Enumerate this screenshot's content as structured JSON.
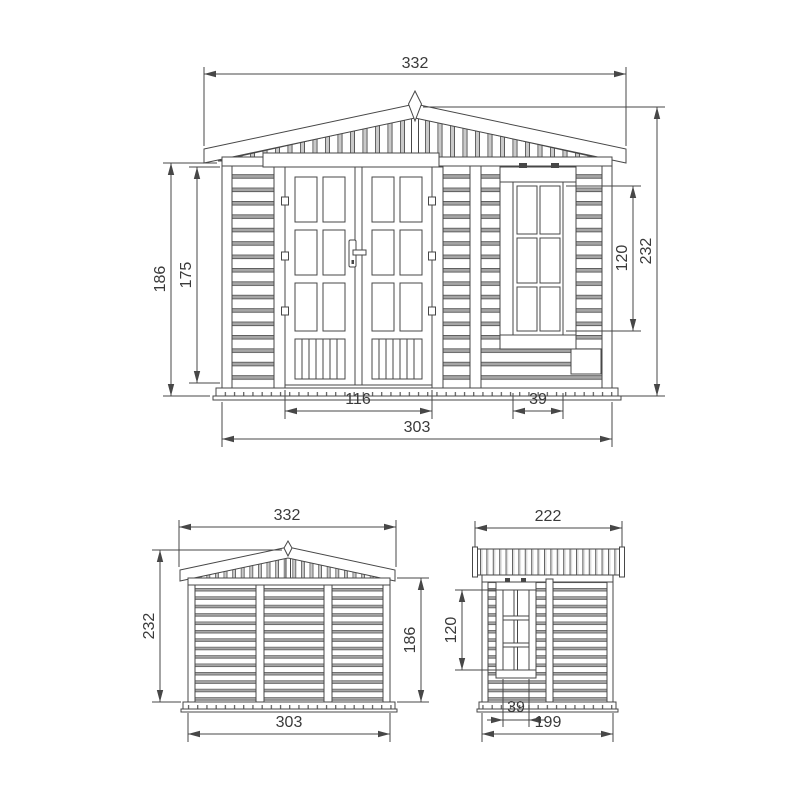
{
  "style": {
    "line_color": "#474747",
    "dim_text_color": "#3a3a3a",
    "background": "#ffffff",
    "shade_gray": "#a6a6a6"
  },
  "front_view": {
    "dim_roof_width": "332",
    "dim_total_height": "232",
    "dim_wall_height": "186",
    "dim_door_height": "175",
    "dim_window_height": "120",
    "dim_door_width": "116",
    "dim_window_width": "39",
    "dim_base_width": "303"
  },
  "rear_view": {
    "dim_roof_width": "332",
    "dim_total_height": "232",
    "dim_wall_height": "186",
    "dim_base_width": "303"
  },
  "side_view": {
    "dim_roof_depth": "222",
    "dim_window_height": "120",
    "dim_window_width": "39",
    "dim_base_depth": "199"
  }
}
